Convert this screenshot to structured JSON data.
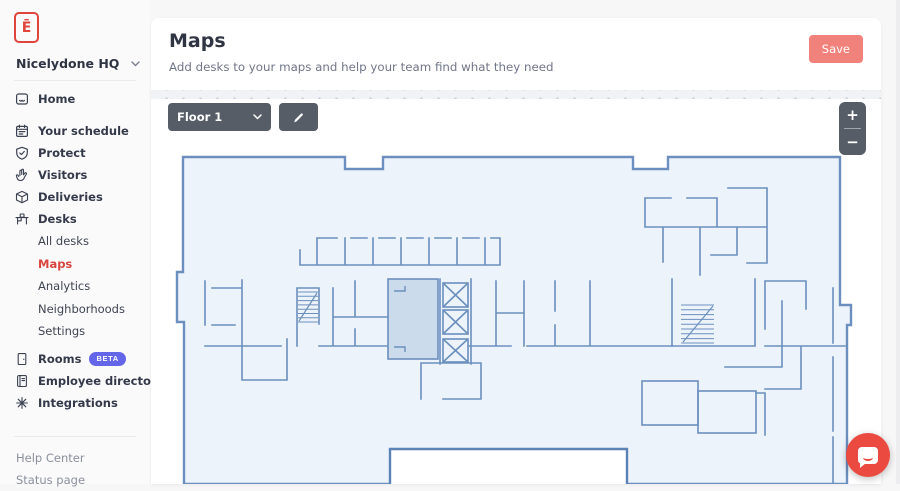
{
  "app": {
    "logo_glyph": "Ē"
  },
  "sidebar": {
    "org_name": "Nicelydone HQ",
    "nav": [
      {
        "label": "Home"
      },
      {
        "label": "Your schedule"
      },
      {
        "label": "Protect"
      },
      {
        "label": "Visitors"
      },
      {
        "label": "Deliveries"
      },
      {
        "label": "Desks"
      }
    ],
    "desks_subnav": [
      {
        "label": "All desks"
      },
      {
        "label": "Maps"
      },
      {
        "label": "Analytics"
      },
      {
        "label": "Neighborhoods"
      },
      {
        "label": "Settings"
      }
    ],
    "secondary": [
      {
        "label": "Rooms",
        "badge": "BETA"
      },
      {
        "label": "Employee directory"
      },
      {
        "label": "Integrations"
      }
    ],
    "footer": [
      {
        "label": "Help Center"
      },
      {
        "label": "Status page"
      }
    ]
  },
  "header": {
    "title": "Maps",
    "subtitle": "Add desks to your maps and help your team find what they need",
    "save_label": "Save"
  },
  "map_toolbar": {
    "floor_label": "Floor 1",
    "zoom_in_label": "+",
    "zoom_out_label": "−"
  },
  "colors": {
    "accent": "#e0453c",
    "save_button": "#f1817b",
    "beta_badge": "#6366e8",
    "toolbar_dark": "#565d66",
    "active_nav": "#d8453e",
    "plan_line": "#6b8fbe",
    "plan_fill": "#edf3fa",
    "room_shaded": "#ccdbeb",
    "chat_button": "#eb4a41"
  }
}
